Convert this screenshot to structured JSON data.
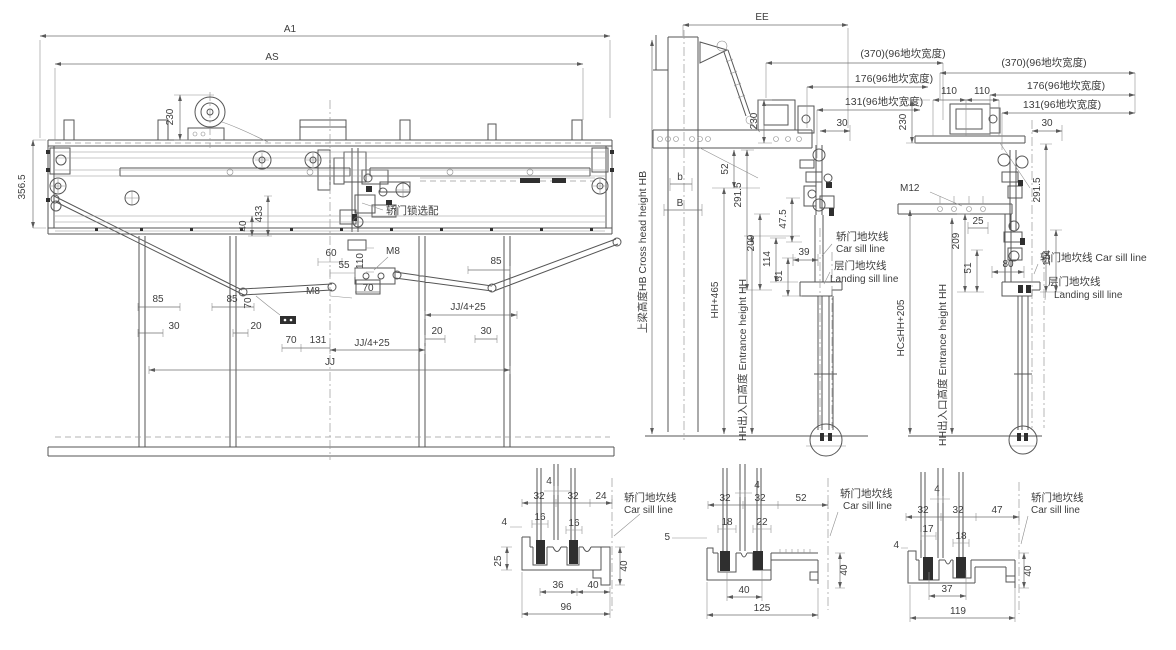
{
  "colors": {
    "background": "#ffffff",
    "line": "#565656",
    "light_line": "#8f8f8f",
    "dim_line": "#6f6f6f",
    "text": "#3d3d3d",
    "insert_fill": "#2f2f2f"
  },
  "labels": {
    "main": {
      "a1": "A1",
      "as": "AS",
      "d230": "230",
      "d3565": "356.5",
      "d40": "40",
      "d433": "433",
      "lock": "轿门锁选配",
      "d60": "60",
      "d55": "55",
      "d110": "110",
      "m8a": "M8",
      "m8b": "M8",
      "d70a": "70",
      "d70b": "70",
      "d70c": "70",
      "d85a": "85",
      "d85b": "85",
      "d85c": "85",
      "d30a": "30",
      "d20a": "20",
      "d131": "131",
      "jj4a": "JJ/4+25",
      "jj4b": "JJ/4+25",
      "d20b": "20",
      "d30b": "30",
      "jj": "JJ"
    },
    "s1": {
      "ee": "EE",
      "hb": "上梁高度HB Cross head height HB",
      "w370": "(370)(96地坎宽度)",
      "w176": "176(96地坎宽度)",
      "w131": "131(96地坎宽度)",
      "d30": "30",
      "d230": "230",
      "b": "b",
      "bb": "B",
      "d52": "52",
      "d2915": "291.5",
      "d475": "47.5",
      "d209": "209",
      "d114": "114",
      "d51": "51",
      "d39": "39",
      "hh465": "HH+465",
      "hh": "HH出入口高度 Entrance height HH",
      "car_cn": "轿门地坎线",
      "car_en": "Car sill line",
      "land_cn": "层门地坎线",
      "land_en": "Landing sill line"
    },
    "s2": {
      "w370": "(370)(96地坎宽度)",
      "w176": "176(96地坎宽度)",
      "w131": "131(96地坎宽度)",
      "d30": "30",
      "d110a": "110",
      "d110b": "110",
      "d230": "230",
      "d2915": "291.5",
      "m12": "M12",
      "d209": "209",
      "d25": "25",
      "d114": "114",
      "d51": "51",
      "d80": "80",
      "car": "轿门地坎线 Car sill line",
      "land_cn": "层门地坎线",
      "land_en": "Landing sill line",
      "hc": "HC≤HH+205",
      "hh": "HH出入口高度 Entrance height HH"
    },
    "sec1": {
      "d4a": "4",
      "d32a": "32",
      "d32b": "32",
      "d24": "24",
      "d16a": "16",
      "d16b": "16",
      "d4b": "4",
      "d25": "25",
      "d40a": "40",
      "d36": "36",
      "d40b": "40",
      "d96": "96",
      "car_cn": "轿门地坎线",
      "car_en": "Car sill line"
    },
    "sec2": {
      "d4": "4",
      "d32a": "32",
      "d32b": "32",
      "d52": "52",
      "d18": "18",
      "d22": "22",
      "d5": "5",
      "d40a": "40",
      "d40b": "40",
      "d125": "125",
      "car_cn": "轿门地坎线",
      "car_en": "Car sill line"
    },
    "sec3": {
      "d4a": "4",
      "d32a": "32",
      "d32b": "32",
      "d47": "47",
      "d17": "17",
      "d18": "18",
      "d4b": "4",
      "d40": "40",
      "d37": "37",
      "d119": "119",
      "car_cn": "轿门地坎线",
      "car_en": "Car sill line"
    }
  }
}
